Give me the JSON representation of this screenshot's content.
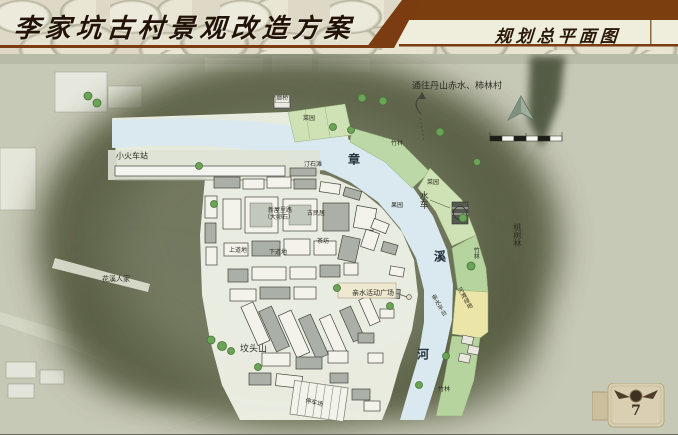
{
  "header": {
    "title": "李家坑古村景观改造方案",
    "subtitle": "规划总平面图"
  },
  "page": {
    "number": "7"
  },
  "map": {
    "colors": {
      "accent_brown": "#7a3c10",
      "river": "#d9e9ef",
      "hill_shade": "#555c41",
      "bamboo_green": "#bcd8a6",
      "beach_yellow": "#ece5a8"
    },
    "labels": [
      {
        "text": "通往丹山赤水、柿林村",
        "x": 412,
        "y": 82,
        "size": 9
      },
      {
        "text": "小火车站",
        "x": 116,
        "y": 153,
        "size": 8
      },
      {
        "text": "廊桥",
        "x": 275,
        "y": 95,
        "size": 6,
        "boxed": true
      },
      {
        "text": "菜园",
        "x": 303,
        "y": 116,
        "size": 6
      },
      {
        "text": "竹林",
        "x": 391,
        "y": 141,
        "size": 6
      },
      {
        "text": "汀石滩",
        "x": 304,
        "y": 162,
        "size": 6
      },
      {
        "text": "章",
        "x": 348,
        "y": 155,
        "size": 12,
        "river": true
      },
      {
        "text": "水车",
        "x": 417,
        "y": 191,
        "size": 9,
        "vertical": true
      },
      {
        "text": "菜园",
        "x": 427,
        "y": 180,
        "size": 6
      },
      {
        "text": "果园",
        "x": 391,
        "y": 203,
        "size": 6
      },
      {
        "text": "溪",
        "x": 434,
        "y": 252,
        "size": 12,
        "river": true
      },
      {
        "text": "竹林",
        "x": 472,
        "y": 247,
        "size": 6,
        "vertical": true
      },
      {
        "text": "桃树林",
        "x": 511,
        "y": 223,
        "size": 8,
        "vertical": true
      },
      {
        "text": "河滩绿地",
        "x": 455,
        "y": 290,
        "size": 6,
        "vertical": true,
        "rotate": -30
      },
      {
        "text": "亲水平台",
        "x": 429,
        "y": 297,
        "size": 6,
        "vertical": true,
        "rotate": -30
      },
      {
        "text": "亲水活动广场",
        "x": 352,
        "y": 290,
        "size": 7
      },
      {
        "text": "河",
        "x": 417,
        "y": 350,
        "size": 12,
        "river": true
      },
      {
        "text": "坟头山",
        "x": 240,
        "y": 345,
        "size": 9
      },
      {
        "text": "停车场",
        "x": 306,
        "y": 398,
        "size": 6,
        "rotate": 14
      },
      {
        "text": "竹林",
        "x": 438,
        "y": 387,
        "size": 6
      },
      {
        "text": "花溪人家",
        "x": 102,
        "y": 276,
        "size": 7
      },
      {
        "text": "新屋里路",
        "x": 268,
        "y": 208,
        "size": 6
      },
      {
        "text": "（大卵石）",
        "x": 264,
        "y": 215,
        "size": 6
      },
      {
        "text": "古民居",
        "x": 307,
        "y": 211,
        "size": 6
      },
      {
        "text": "茶坊",
        "x": 317,
        "y": 239,
        "size": 6
      },
      {
        "text": "上道地",
        "x": 229,
        "y": 248,
        "size": 6
      },
      {
        "text": "下道地",
        "x": 269,
        "y": 250,
        "size": 6
      }
    ]
  }
}
